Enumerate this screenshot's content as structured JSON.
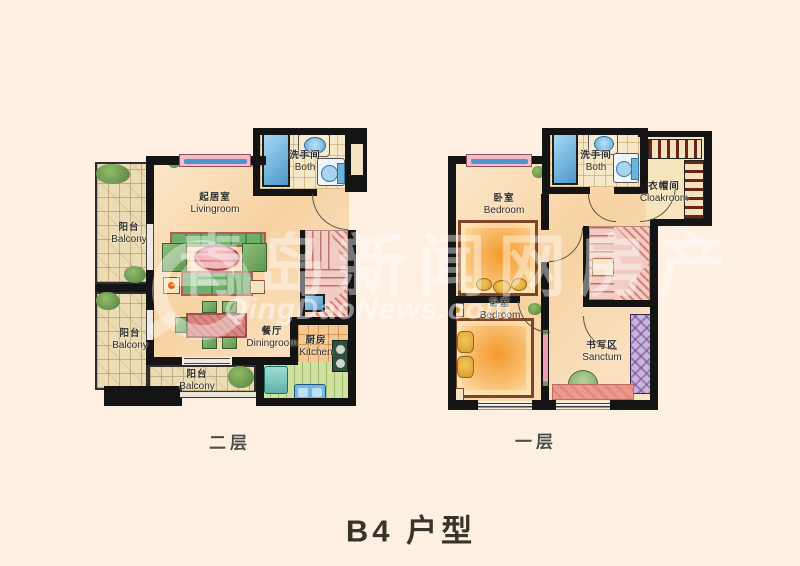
{
  "title": {
    "text": "B4 户型"
  },
  "watermark": {
    "site_cn": "青岛新闻网房产",
    "site_url": "QingDaoNews.com",
    "logo": "qingdaonews-circle-logo"
  },
  "floors": {
    "second": {
      "label": "二层",
      "rooms": {
        "livingroom": {
          "cn": "起居室",
          "en": "Livingroom"
        },
        "balcony_upper": {
          "cn": "阳台",
          "en": "Balcony"
        },
        "balcony_lower": {
          "cn": "阳台",
          "en": "Balcony"
        },
        "balcony_bottom": {
          "cn": "阳台",
          "en": "Balcony"
        },
        "diningroom": {
          "cn": "餐厅",
          "en": "Diningroom"
        },
        "kitchen": {
          "cn": "厨房",
          "en": "Kitchen"
        },
        "bath": {
          "cn": "洗手间",
          "en": "Both"
        }
      }
    },
    "first": {
      "label": "一层",
      "rooms": {
        "bedroom_upper": {
          "cn": "卧室",
          "en": "Bedroom"
        },
        "bedroom_lower": {
          "cn": "卧室",
          "en": "Bedroom"
        },
        "bath": {
          "cn": "洗手间",
          "en": "Both"
        },
        "cloakroom": {
          "cn": "衣帽间",
          "en": "Cloakroom"
        },
        "sanctum": {
          "cn": "书写区",
          "en": "Sanctum"
        }
      }
    }
  },
  "colors": {
    "background": "#FDF0E2",
    "wall": "#141414",
    "interior_peach": "#F8DCB2",
    "balcony_tile": "#ECDCB6",
    "bath_tile": "#F6E8C6",
    "kitchen_tile": "#F4C892",
    "kitchen_green": "#CFE2A2",
    "stairs_pink": "#F2CBC2",
    "fixture_blue": "#5B9FD4",
    "sofa_green": "#6FAE6A",
    "accent_red": "#C96B63",
    "bed_orange": "#F49A2E",
    "cabinet_purple": "#C9B4DC",
    "watermark_white": "rgba(255,255,255,0.45)",
    "title_text": "#38332B"
  }
}
